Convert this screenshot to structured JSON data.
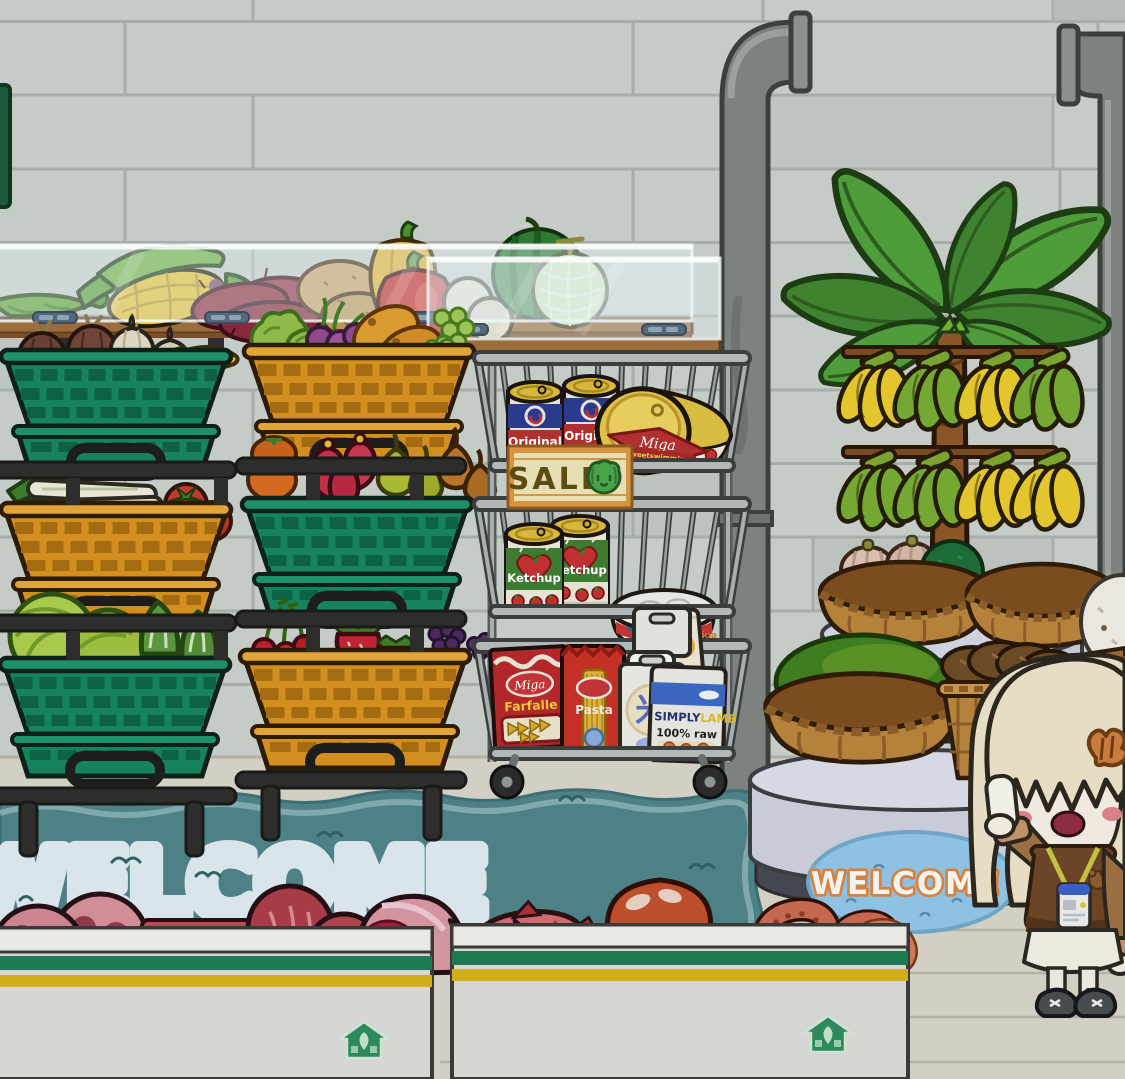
{
  "signs": {
    "sale": {
      "label": "SALE",
      "icon": "cabbage-face-icon"
    },
    "rug": {
      "text": "WELCOME"
    },
    "doormat": {
      "text": "WELCOME"
    }
  },
  "products": {
    "baked_beans_can": {
      "label": "Original",
      "sub_label": "Baked beans",
      "count": 2
    },
    "fish_can_large": {
      "brand": "Miga",
      "label": "Sweetswimming"
    },
    "ketchup_can": {
      "label": "Ketchup",
      "count": 2
    },
    "fish_can_small": {
      "brand": "miga"
    },
    "farfalle_box": {
      "brand": "Miga",
      "label": "Farfalle"
    },
    "pasta_bag": {
      "label": "Pasta"
    },
    "rice_bag": {
      "label": "米"
    },
    "lamb_pack": {
      "brand": "SIMPLY",
      "type": "LAMB",
      "sub_label": "100% raw"
    }
  },
  "shelves": {
    "left_unit": {
      "baskets": [
        {
          "color": "green",
          "items": [
            "brown onions",
            "garlic",
            "yellow pepper"
          ]
        },
        {
          "color": "orange",
          "items": [
            "leeks",
            "tomatoes"
          ]
        },
        {
          "color": "green",
          "items": [
            "cabbages",
            "napa cabbage"
          ]
        }
      ]
    },
    "right_unit": {
      "baskets": [
        {
          "color": "orange",
          "items": [
            "lettuce",
            "radishes",
            "mangoes",
            "grapes"
          ]
        },
        {
          "color": "green",
          "items": [
            "persimmons",
            "red apples",
            "green pears",
            "brown pears"
          ]
        },
        {
          "color": "orange",
          "items": [
            "cherries",
            "strawberries",
            "blackberries"
          ]
        }
      ]
    },
    "wire_cart": {
      "tiers": [
        [
          "baked beans cans",
          "canned fish"
        ],
        [
          "ketchup cans",
          "canned fish"
        ],
        [
          "farfalle box",
          "pasta bag",
          "rice bag",
          "lamb pack"
        ]
      ]
    }
  },
  "produce_table": {
    "items": [
      "peas",
      "corn",
      "sweet potatoes",
      "potatoes",
      "yellow pepper",
      "red pepper",
      "white onions",
      "watermelon",
      "melon"
    ]
  },
  "display_island": {
    "plant": "banana tree",
    "baskets": [
      "striped squash with green melon",
      "empty basket",
      "large green melon",
      "mushrooms",
      "white egg in bucket"
    ]
  },
  "freezers": {
    "meat_counter": [
      "salami",
      "marbled beef",
      "steak",
      "ham"
    ],
    "seafood_counter": [
      "red fish",
      "octopus",
      "tentacles",
      "shrimp"
    ],
    "logo": "green-house-icon"
  },
  "character": {
    "role": "shopkeeper girl",
    "accessories": [
      "orange hair clip",
      "lanyard id badge",
      "phone"
    ]
  },
  "colors": {
    "wall": "#c5cbc6",
    "floor": "#d2cfc5",
    "rug": "#4d8186",
    "doormat": "#8fc2e2",
    "basket_green": "#17835c",
    "basket_orange": "#d28e1e",
    "freezer_green": "#1d7a52",
    "freezer_yellow": "#d0ae17",
    "sale_frame": "#d8953f"
  }
}
